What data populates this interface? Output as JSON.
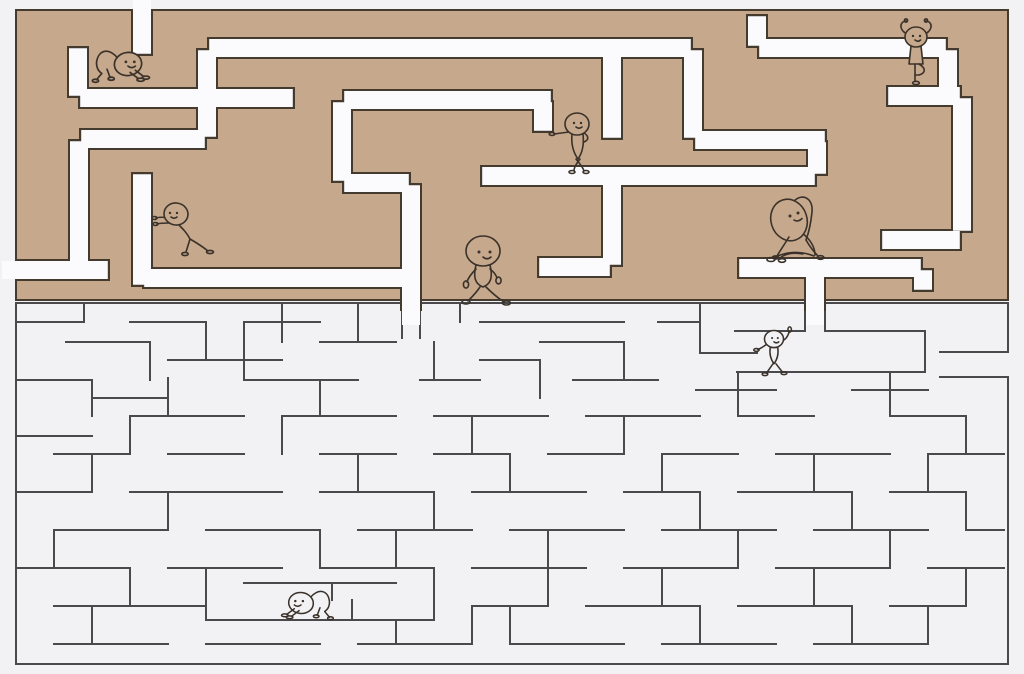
{
  "scene": {
    "description": "Two stacked rectangular mazes: top maze is tan with wide white corridors, bottom maze is light gray with thin dark wall lines; small doodle stick figures in yoga and walking poses are scattered through the corridors.",
    "canvas": {
      "width": 1024,
      "height": 674
    }
  },
  "colors": {
    "background": "#f2f1f4",
    "maze_fill": "#c6a88c",
    "maze_outline": "#453a2e",
    "corridor": "#fbfbfd",
    "wall_line": "#4a4a4c",
    "figure_line": "#3a322a"
  },
  "top_maze": {
    "x": 16,
    "y": 10,
    "width": 992,
    "height": 290,
    "corridor_width": 18,
    "outline_extra": 4,
    "segments": [
      [
        142,
        10,
        142,
        56,
        "open",
        null
      ],
      [
        78,
        46,
        78,
        98,
        null,
        null
      ],
      [
        78,
        98,
        295,
        98,
        null,
        null
      ],
      [
        207,
        48,
        207,
        139,
        null,
        null
      ],
      [
        207,
        48,
        693,
        48,
        null,
        null
      ],
      [
        612,
        48,
        612,
        140,
        null,
        null
      ],
      [
        79,
        139,
        207,
        139,
        null,
        null
      ],
      [
        79,
        139,
        79,
        270,
        null,
        null
      ],
      [
        16,
        270,
        110,
        270,
        "open",
        null
      ],
      [
        142,
        172,
        142,
        287,
        null,
        null
      ],
      [
        142,
        278,
        411,
        278,
        null,
        null
      ],
      [
        342,
        100,
        553,
        100,
        null,
        null
      ],
      [
        342,
        100,
        342,
        183,
        null,
        null
      ],
      [
        543,
        100,
        543,
        133,
        null,
        null
      ],
      [
        342,
        183,
        411,
        183,
        null,
        null
      ],
      [
        411,
        183,
        411,
        311,
        null,
        "open"
      ],
      [
        480,
        176,
        817,
        176,
        null,
        null
      ],
      [
        612,
        176,
        612,
        267,
        null,
        null
      ],
      [
        537,
        267,
        612,
        267,
        null,
        null
      ],
      [
        693,
        48,
        693,
        140,
        null,
        null
      ],
      [
        693,
        140,
        827,
        140,
        null,
        null
      ],
      [
        817,
        140,
        817,
        176,
        null,
        null
      ],
      [
        757,
        14,
        757,
        48,
        null,
        null
      ],
      [
        757,
        48,
        948,
        48,
        null,
        null
      ],
      [
        948,
        48,
        948,
        96,
        null,
        null
      ],
      [
        886,
        96,
        962,
        96,
        null,
        null
      ],
      [
        962,
        96,
        962,
        233,
        null,
        null
      ],
      [
        880,
        240,
        962,
        240,
        null,
        null
      ],
      [
        737,
        268,
        923,
        268,
        null,
        null
      ],
      [
        923,
        268,
        923,
        292,
        null,
        null
      ],
      [
        815,
        268,
        815,
        311,
        null,
        "open"
      ]
    ]
  },
  "bottom_maze": {
    "x": 16,
    "y": 303,
    "width": 992,
    "height": 361,
    "wall_width": 2.4,
    "segments": [
      [
        16,
        303,
        402,
        303
      ],
      [
        420,
        303,
        805,
        303
      ],
      [
        825,
        303,
        1008,
        303
      ],
      [
        16,
        303,
        16,
        664
      ],
      [
        16,
        664,
        1008,
        664
      ],
      [
        1008,
        303,
        1008,
        352
      ],
      [
        1008,
        377,
        1008,
        664
      ],
      [
        940,
        352,
        1008,
        352
      ],
      [
        940,
        377,
        1008,
        377
      ],
      [
        402,
        303,
        402,
        338
      ],
      [
        420,
        303,
        420,
        338
      ],
      [
        805,
        303,
        805,
        331
      ],
      [
        825,
        303,
        825,
        331
      ],
      [
        735,
        331,
        805,
        331
      ],
      [
        825,
        331,
        925,
        331
      ],
      [
        737,
        372,
        925,
        372
      ],
      [
        925,
        331,
        925,
        372
      ],
      [
        700,
        353,
        757,
        353
      ],
      [
        16,
        322,
        84,
        322
      ],
      [
        130,
        322,
        206,
        322
      ],
      [
        244,
        322,
        320,
        322
      ],
      [
        480,
        322,
        624,
        322
      ],
      [
        658,
        322,
        700,
        322
      ],
      [
        66,
        342,
        150,
        342
      ],
      [
        320,
        342,
        396,
        342
      ],
      [
        540,
        342,
        624,
        342
      ],
      [
        168,
        360,
        282,
        360
      ],
      [
        480,
        360,
        540,
        360
      ],
      [
        16,
        380,
        92,
        380
      ],
      [
        244,
        380,
        358,
        380
      ],
      [
        420,
        380,
        480,
        380
      ],
      [
        573,
        380,
        658,
        380
      ],
      [
        696,
        390,
        776,
        390
      ],
      [
        852,
        390,
        928,
        390
      ],
      [
        92,
        398,
        168,
        398
      ],
      [
        130,
        416,
        244,
        416
      ],
      [
        282,
        416,
        396,
        416
      ],
      [
        434,
        416,
        548,
        416
      ],
      [
        586,
        416,
        700,
        416
      ],
      [
        738,
        416,
        814,
        416
      ],
      [
        890,
        416,
        966,
        416
      ],
      [
        16,
        436,
        92,
        436
      ],
      [
        54,
        454,
        130,
        454
      ],
      [
        168,
        454,
        244,
        454
      ],
      [
        320,
        454,
        396,
        454
      ],
      [
        434,
        454,
        510,
        454
      ],
      [
        548,
        454,
        624,
        454
      ],
      [
        662,
        454,
        738,
        454
      ],
      [
        776,
        454,
        890,
        454
      ],
      [
        928,
        454,
        1004,
        454
      ],
      [
        16,
        492,
        92,
        492
      ],
      [
        130,
        492,
        282,
        492
      ],
      [
        320,
        492,
        434,
        492
      ],
      [
        472,
        492,
        586,
        492
      ],
      [
        624,
        492,
        700,
        492
      ],
      [
        738,
        492,
        852,
        492
      ],
      [
        890,
        492,
        966,
        492
      ],
      [
        54,
        530,
        168,
        530
      ],
      [
        206,
        530,
        320,
        530
      ],
      [
        358,
        530,
        472,
        530
      ],
      [
        510,
        530,
        624,
        530
      ],
      [
        662,
        530,
        776,
        530
      ],
      [
        814,
        530,
        928,
        530
      ],
      [
        966,
        530,
        1004,
        530
      ],
      [
        16,
        568,
        130,
        568
      ],
      [
        168,
        568,
        282,
        568
      ],
      [
        320,
        568,
        434,
        568
      ],
      [
        472,
        568,
        586,
        568
      ],
      [
        624,
        568,
        738,
        568
      ],
      [
        776,
        568,
        890,
        568
      ],
      [
        928,
        568,
        1004,
        568
      ],
      [
        244,
        583,
        396,
        583
      ],
      [
        54,
        606,
        206,
        606
      ],
      [
        472,
        606,
        548,
        606
      ],
      [
        586,
        606,
        700,
        606
      ],
      [
        738,
        606,
        852,
        606
      ],
      [
        890,
        606,
        966,
        606
      ],
      [
        206,
        620,
        434,
        620
      ],
      [
        54,
        644,
        168,
        644
      ],
      [
        206,
        644,
        320,
        644
      ],
      [
        358,
        644,
        472,
        644
      ],
      [
        510,
        644,
        624,
        644
      ],
      [
        662,
        644,
        776,
        644
      ],
      [
        814,
        644,
        928,
        644
      ],
      [
        84,
        303,
        84,
        322
      ],
      [
        282,
        303,
        282,
        342
      ],
      [
        358,
        303,
        358,
        342
      ],
      [
        460,
        303,
        460,
        322
      ],
      [
        700,
        303,
        700,
        353
      ],
      [
        150,
        342,
        150,
        380
      ],
      [
        206,
        322,
        206,
        360
      ],
      [
        244,
        322,
        244,
        380
      ],
      [
        434,
        342,
        434,
        380
      ],
      [
        540,
        360,
        540,
        398
      ],
      [
        624,
        342,
        624,
        380
      ],
      [
        92,
        380,
        92,
        416
      ],
      [
        168,
        378,
        168,
        416
      ],
      [
        320,
        380,
        320,
        416
      ],
      [
        738,
        372,
        738,
        416
      ],
      [
        890,
        372,
        890,
        416
      ],
      [
        472,
        416,
        472,
        454
      ],
      [
        130,
        416,
        130,
        454
      ],
      [
        282,
        416,
        282,
        454
      ],
      [
        624,
        416,
        624,
        454
      ],
      [
        966,
        416,
        966,
        454
      ],
      [
        92,
        454,
        92,
        492
      ],
      [
        358,
        454,
        358,
        492
      ],
      [
        510,
        454,
        510,
        492
      ],
      [
        662,
        454,
        662,
        492
      ],
      [
        814,
        454,
        814,
        492
      ],
      [
        928,
        454,
        928,
        492
      ],
      [
        168,
        492,
        168,
        530
      ],
      [
        434,
        492,
        434,
        530
      ],
      [
        700,
        492,
        700,
        530
      ],
      [
        852,
        492,
        852,
        530
      ],
      [
        966,
        492,
        966,
        530
      ],
      [
        54,
        530,
        54,
        568
      ],
      [
        320,
        530,
        320,
        568
      ],
      [
        396,
        530,
        396,
        568
      ],
      [
        548,
        530,
        548,
        568
      ],
      [
        738,
        530,
        738,
        568
      ],
      [
        890,
        530,
        890,
        568
      ],
      [
        130,
        568,
        130,
        606
      ],
      [
        206,
        568,
        206,
        620
      ],
      [
        332,
        583,
        332,
        600
      ],
      [
        352,
        600,
        352,
        620
      ],
      [
        434,
        568,
        434,
        620
      ],
      [
        548,
        568,
        548,
        606
      ],
      [
        662,
        568,
        662,
        606
      ],
      [
        814,
        568,
        814,
        606
      ],
      [
        966,
        568,
        966,
        606
      ],
      [
        92,
        606,
        92,
        644
      ],
      [
        396,
        620,
        396,
        644
      ],
      [
        472,
        606,
        472,
        644
      ],
      [
        510,
        606,
        510,
        644
      ],
      [
        700,
        606,
        700,
        644
      ],
      [
        852,
        606,
        852,
        644
      ],
      [
        928,
        606,
        928,
        644
      ]
    ]
  },
  "figures": [
    {
      "name": "crawling-figure-top-left",
      "pose": "crawl",
      "maze": "top",
      "x": 128,
      "y": 64,
      "scale": 1.05,
      "flip": false
    },
    {
      "name": "wall-stretch-figure",
      "pose": "wallpush",
      "maze": "top",
      "x": 176,
      "y": 214,
      "scale": 1.0,
      "flip": false
    },
    {
      "name": "leaning-figure",
      "pose": "lean",
      "maze": "top",
      "x": 577,
      "y": 124,
      "scale": 1.0,
      "flip": false
    },
    {
      "name": "walking-figure",
      "pose": "walk",
      "maze": "top",
      "x": 483,
      "y": 251,
      "scale": 1.0,
      "flip": false
    },
    {
      "name": "side-stretch-figure",
      "pose": "stretch",
      "maze": "top",
      "x": 789,
      "y": 220,
      "scale": 1.0,
      "flip": false
    },
    {
      "name": "tree-pose-figure",
      "pose": "tree",
      "maze": "top",
      "x": 916,
      "y": 37,
      "scale": 1.0,
      "flip": false
    },
    {
      "name": "dancing-figure",
      "pose": "dance",
      "maze": "bottom",
      "x": 774,
      "y": 339,
      "scale": 0.95,
      "flip": false
    },
    {
      "name": "crawling-figure-bottom",
      "pose": "crawl",
      "maze": "bottom",
      "x": 301,
      "y": 603,
      "scale": 0.95,
      "flip": true
    }
  ]
}
